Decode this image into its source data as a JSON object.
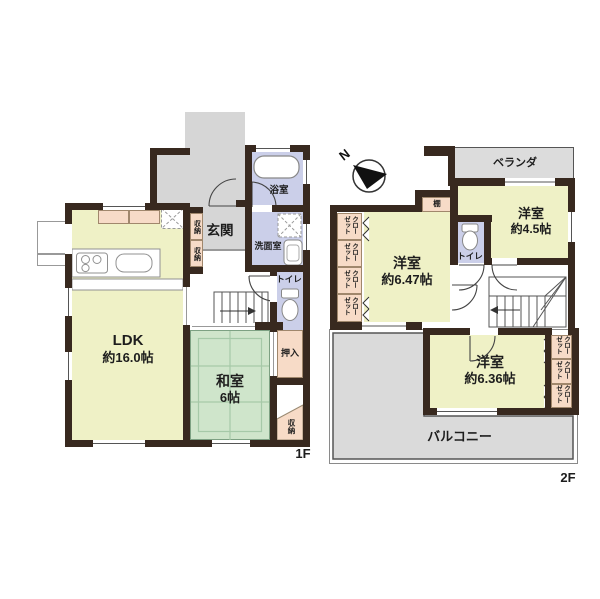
{
  "colors": {
    "wall": "#38291f",
    "room_yellow": "#eff1c6",
    "tatami_green": "#cfe5cb",
    "wet_lavender": "#cbcfe9",
    "storage_pink": "#f7dbc7",
    "outdoor_gray": "#d6d6d6"
  },
  "compass": {
    "north": "N"
  },
  "floor1": {
    "label": "1F",
    "ldk": {
      "name": "LDK",
      "size": "約16.0帖"
    },
    "washitsu": {
      "name": "和室",
      "size": "6帖"
    },
    "genkan": "玄関",
    "bath": "浴室",
    "washroom": "洗面室",
    "toilet": "トイレ",
    "oshiire": "押入",
    "hall_storage": [
      "収納",
      "収納"
    ],
    "corner_storage": "収納"
  },
  "floor2": {
    "label": "2F",
    "veranda": "ベランダ",
    "bedroom_a": {
      "name": "洋室",
      "size": "約4.5帖"
    },
    "bedroom_b": {
      "name": "洋室",
      "size": "約6.47帖"
    },
    "bedroom_c": {
      "name": "洋室",
      "size": "約6.36帖"
    },
    "toilet": "トイレ",
    "shelf": "棚",
    "balcony": "バルコニー",
    "closets_left": [
      "クローゼット",
      "クローゼット",
      "クローゼット",
      "クローゼット"
    ],
    "closets_right": [
      "クローゼット",
      "クローゼット",
      "クローゼット"
    ]
  }
}
